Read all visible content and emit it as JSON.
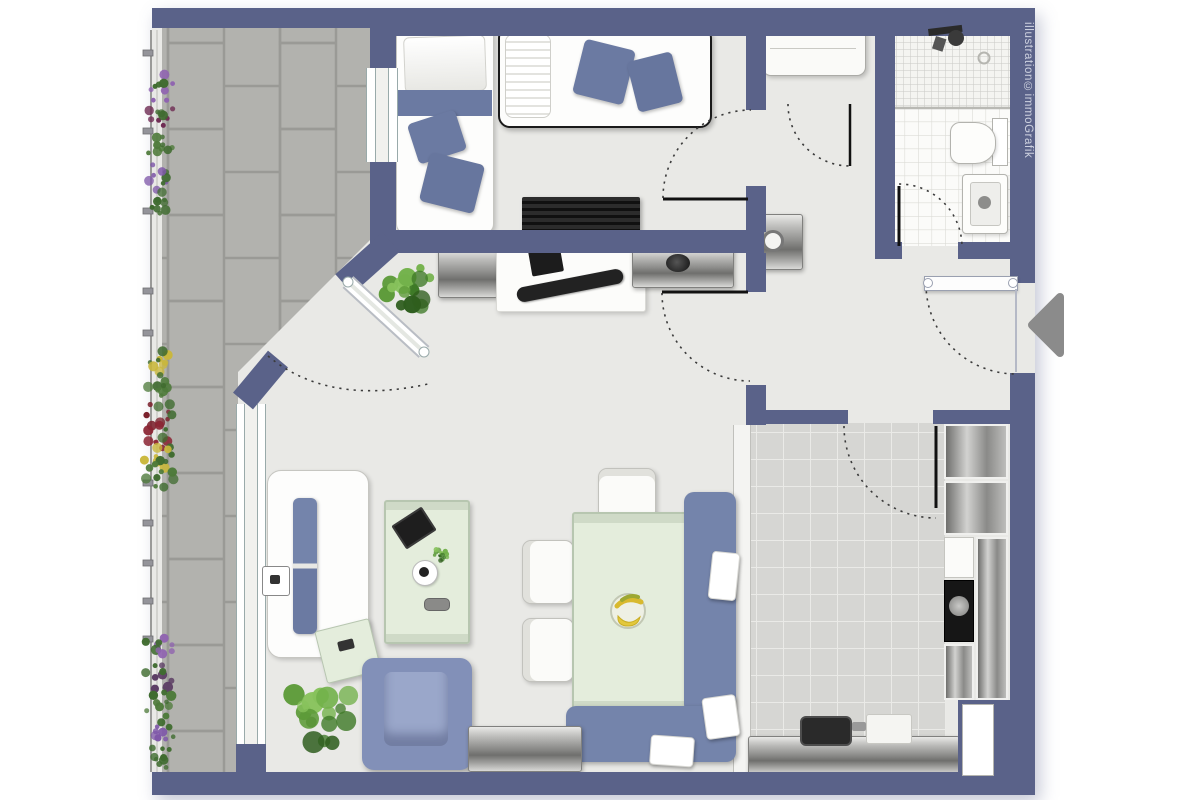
{
  "watermark": {
    "text": "illustration©immoGrafik"
  },
  "colors": {
    "wall": "#5a6289",
    "floor": "#e9e9e6",
    "balcony_tile": "#b2b2ae",
    "balcony_grout": "#9a9a96",
    "kitchen_tile": "#d6d6d3",
    "accent_blue": "#7484ab",
    "accent_blue_dark": "#6b7aa2",
    "armchair_blue": "#8290b8",
    "table_green": "#e4eddc",
    "metal": "#9a9a98",
    "arrow_gray": "#8b8b8b",
    "dark_object": "#1f1f1f"
  },
  "rooms": [
    "balcony",
    "bedroom",
    "closet",
    "bathroom",
    "hallway",
    "living-dining-area",
    "kitchen"
  ],
  "furniture": [
    "single-bed",
    "single-bed",
    "tv-sideboard",
    "wardrobe",
    "washing-machine",
    "shower",
    "toilet",
    "wash-basin",
    "hall-sideboard",
    "desk",
    "laptop",
    "hall-cabinet",
    "sofa",
    "coffee-table",
    "side-table",
    "armchair",
    "potted-plant",
    "potted-plant",
    "table-plant",
    "dining-table",
    "fruit-bowl",
    "dining-chair",
    "dining-chair",
    "dining-chair",
    "corner-bench",
    "seat-cushions",
    "living-sideboard",
    "kitchen-cabinets",
    "oven",
    "kitchen-counter",
    "kitchen-sink",
    "cutting-board",
    "balcony-flower-box",
    "balcony-flower-box",
    "balcony-flower-box",
    "balcony-railing",
    "entrance-arrow"
  ],
  "flora": {
    "plant_palette": [
      "#3f7a28",
      "#5c9a38",
      "#72b14a",
      "#2f5e1e",
      "#87c25c"
    ],
    "plants": [
      {
        "cx": 408,
        "cy": 288,
        "r": 31
      },
      {
        "cx": 320,
        "cy": 714,
        "r": 38
      },
      {
        "cx": 441,
        "cy": 555,
        "r": 9
      }
    ],
    "flower_boxes": [
      {
        "x": 160,
        "clusters": [
          {
            "y": 88,
            "color": "#8f63b0"
          },
          {
            "y": 116,
            "color": "#6e2a52"
          },
          {
            "y": 146,
            "color": "#4e7a3a"
          },
          {
            "y": 176,
            "color": "#7e57a8"
          },
          {
            "y": 202,
            "color": "#3f6b2f"
          }
        ]
      },
      {
        "x": 160,
        "clusters": [
          {
            "y": 362,
            "color": "#c9b73a"
          },
          {
            "y": 388,
            "color": "#4e7a3a"
          },
          {
            "y": 414,
            "color": "#7a1f2b"
          },
          {
            "y": 438,
            "color": "#8a2433"
          },
          {
            "y": 458,
            "color": "#c9b73a"
          },
          {
            "y": 474,
            "color": "#4e7a3a"
          }
        ]
      },
      {
        "x": 160,
        "clusters": [
          {
            "y": 648,
            "color": "#8f63b0"
          },
          {
            "y": 676,
            "color": "#5a3b63"
          },
          {
            "y": 704,
            "color": "#4e7a3a"
          },
          {
            "y": 732,
            "color": "#7e57a8"
          },
          {
            "y": 757,
            "color": "#3f6b2f"
          }
        ]
      }
    ]
  }
}
